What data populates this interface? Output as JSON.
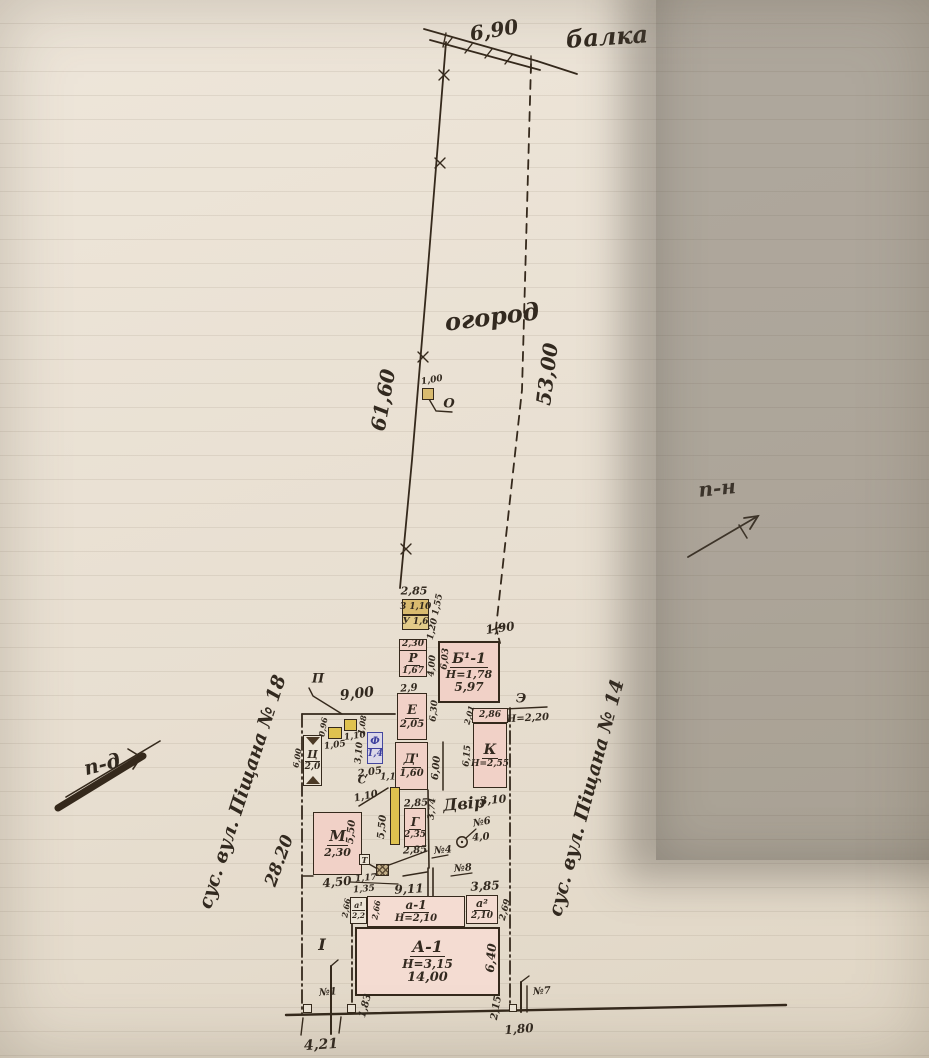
{
  "colors": {
    "ink": "#35291c",
    "paper": "#e9e1d4",
    "room_pink": "#f1d1c7",
    "shed_tan": "#d9bb6f",
    "strip_yellow": "#dfc24f",
    "f_blue": "#3d3f9e",
    "photo_shadow": "#8d877e"
  },
  "site": {
    "balka_label": "балка",
    "balka_length": "6,90",
    "garden_label": "огород",
    "left_boundary_length": "61,60",
    "right_boundary_length": "53,00",
    "boundary_jog": "1,90",
    "north_label": "п-н",
    "road_label": "п-д",
    "neighbor_left": "сус. вул. Піщана № 18",
    "neighbor_right": "сус. вул. Піщана № 14",
    "left_fence_length": "28.20",
    "shed_o_label": "О",
    "shed_o_size": "1,00"
  },
  "labels": {
    "dim285top": "2,85",
    "zbox": "З 1,10",
    "ubox": "У 1,6",
    "dim120155": "1,20 1,55",
    "r230": "2,30",
    "r": "Р",
    "r167": "1,67",
    "dim400": "4,00",
    "b11": "Б¹-1",
    "b1h": "Н=1,78",
    "dim597": "5,97",
    "dim603": "6,03",
    "dim29": "2,9",
    "e": "Е",
    "e205": "2,05",
    "dim630": "6,30",
    "d": "Д'",
    "d160": "1,60",
    "dim600court": "6,00",
    "dim285d": "2,85",
    "dim201": "2,01",
    "dim286": "2,86",
    "ae": "Э",
    "h220": "Н=2,20",
    "k": "К",
    "kh": "Н=2,55",
    "dim615": "6,15",
    "dvir": "Двір",
    "dim310dvir": "3,10",
    "dim374": "3,74",
    "n6": "№6",
    "dim40": "4,0",
    "n4": "№4",
    "n8": "№8",
    "dim385": "3,85",
    "p": "П",
    "dim900": "9,00",
    "dim105": "1,05",
    "dim096": "0,96",
    "dim110box": "1,10",
    "dim108": "1,08",
    "f": "Ф",
    "f14": "1,4",
    "dim310f": "3,10",
    "c": "Ц",
    "c20": "2,0",
    "dim600c": "6,00",
    "dim205": "2,05",
    "s": "С",
    "dim11": "1,1",
    "dim110diag": "1,10",
    "m": "М",
    "m230": "2,30",
    "dim550m": "5,50",
    "dim550l": "5,50",
    "g": "Г",
    "g235": "2,35",
    "dim285g": "2,85",
    "dim450": "4,50",
    "dim117": "1,17",
    "dim135": "1,35",
    "dim911": "9,11",
    "t": "Т",
    "a1s": "а¹",
    "a1s22": "2,2",
    "dim266a": "2,66",
    "dim266b": "2,66",
    "a1": "а-1",
    "a1h": "Н=2,10",
    "a2": "а²",
    "a2h": "2,10",
    "dim269": "2,69",
    "A1": "А-1",
    "A1h": "Н=3,15",
    "A1w": "14,00",
    "dim640": "6,40",
    "strip1": "I",
    "n1": "№1",
    "dim421": "4,21",
    "dim183": "1,83",
    "n7": "№7",
    "dim215": "2,15",
    "dim180": "1,80"
  }
}
